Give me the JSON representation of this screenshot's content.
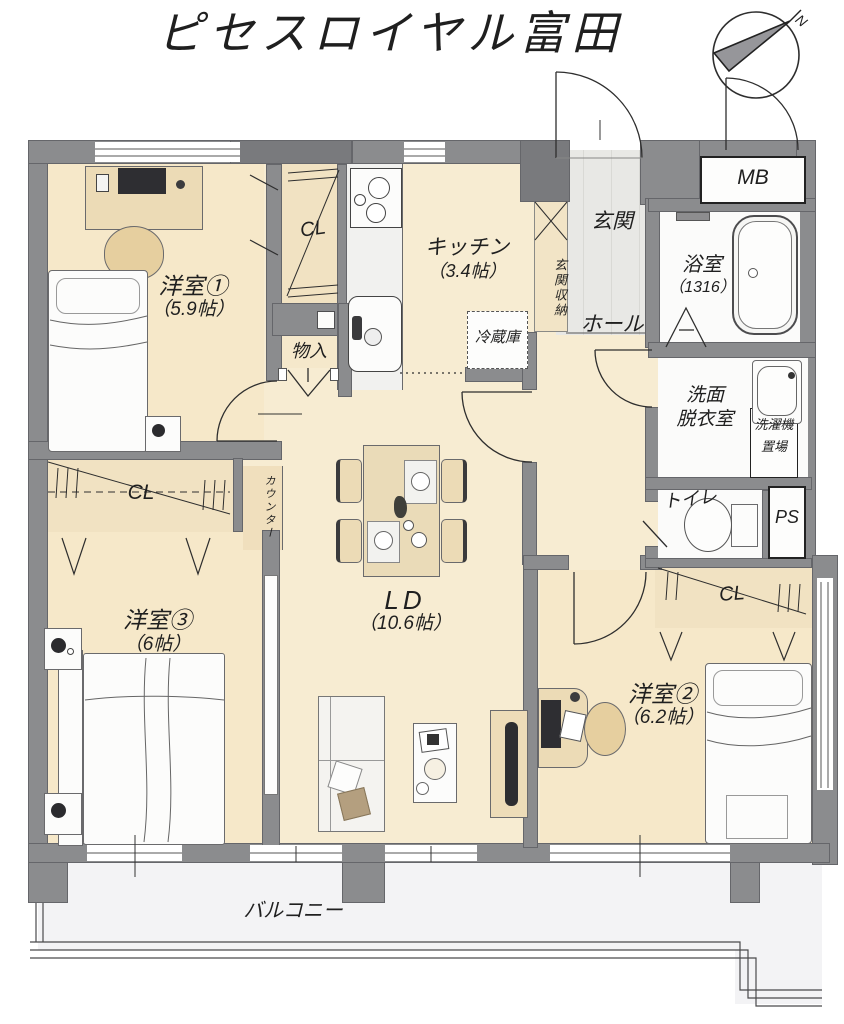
{
  "title": "ピセスロイヤル富田",
  "compass": {
    "north_label": "N"
  },
  "rooms": {
    "western1": {
      "name": "洋室①",
      "size": "（5.9帖）"
    },
    "western2": {
      "name": "洋室②",
      "size": "（6.2帖）"
    },
    "western3": {
      "name": "洋室③",
      "size": "（6帖）"
    },
    "living": {
      "name": "LD",
      "size": "（10.6帖）"
    },
    "kitchen": {
      "name": "キッチン",
      "size": "（3.4帖）"
    },
    "entrance": {
      "name": "玄関"
    },
    "hall": {
      "name": "ホール"
    },
    "bath": {
      "name": "浴室",
      "size": "（1316）"
    },
    "washroom": {
      "line1": "洗面",
      "line2": "脱衣室"
    },
    "laundry": {
      "line1": "洗濯機",
      "line2": "置場"
    },
    "toilet": {
      "name": "トイレ"
    },
    "balcony": {
      "name": "バルコニー"
    }
  },
  "storage": {
    "closet1": "CL",
    "closet2": "CL",
    "closet3": "CL",
    "storeroom": "物入",
    "entrance_storage": "玄関収納",
    "counter": "カウンター",
    "refrigerator": "冷蔵庫"
  },
  "utility": {
    "meter_box": "MB",
    "pipe_space": "PS"
  },
  "colors": {
    "wall_gray": "#8b8c8e",
    "floor_cream": "#f7ecd2",
    "room_cream": "#f6e8c9",
    "closet_tan": "#f1e2c2",
    "entrance_tile": "#e7e7e4",
    "sanitary_white": "#fbfbfa",
    "balcony_gray": "#f3f3f5",
    "line_dark": "#2e2e2e"
  }
}
